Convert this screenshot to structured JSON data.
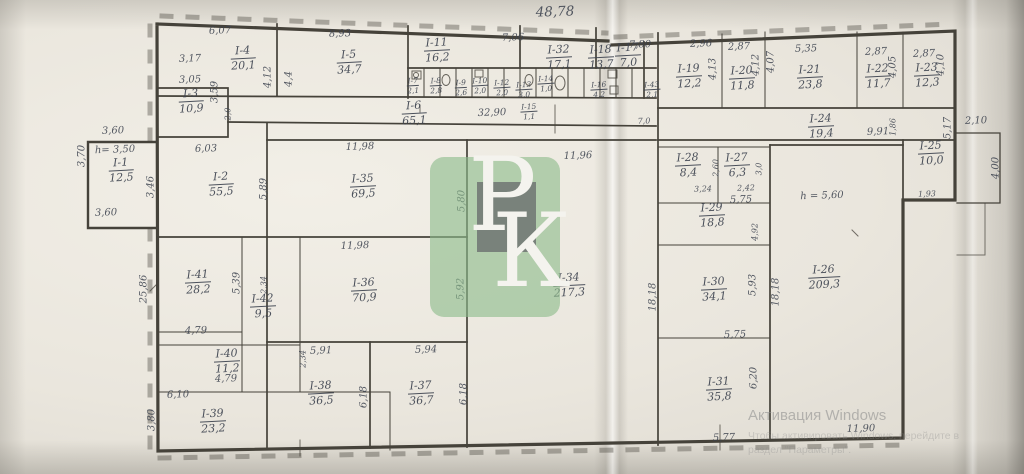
{
  "colors": {
    "ink": "#3e4450",
    "wall": "#45423a",
    "paper": "#ece8df",
    "logo_green": "#8dbc8a"
  },
  "windows_watermark": {
    "line1": "Активация Windows",
    "line2": "Чтобы активировать Windows, перейдите в",
    "line3": "раздел \"Параметры\"."
  },
  "watermark_logo": {
    "letter_p": "Р",
    "letter_k": "К"
  },
  "plan": {
    "overall_length": "48,78",
    "rooms": [
      {
        "id": "I-1",
        "area": "12,5",
        "x": 121,
        "y": 170
      },
      {
        "id": "I-2",
        "area": "55,5",
        "x": 221,
        "y": 184
      },
      {
        "id": "I-3",
        "area": "10,9",
        "x": 191,
        "y": 101
      },
      {
        "id": "I-4",
        "area": "20,1",
        "x": 243,
        "y": 58
      },
      {
        "id": "I-5",
        "area": "34,7",
        "x": 349,
        "y": 62
      },
      {
        "id": "I-6",
        "area": "65,1",
        "x": 414,
        "y": 113
      },
      {
        "id": "I-7",
        "area": "2,1",
        "x": 413,
        "y": 86,
        "small": true
      },
      {
        "id": "I-8",
        "area": "2,8",
        "x": 436,
        "y": 86,
        "small": true
      },
      {
        "id": "I-9",
        "area": "2,6",
        "x": 461,
        "y": 88,
        "small": true
      },
      {
        "id": "I-10",
        "area": "2,0",
        "x": 480,
        "y": 86,
        "small": true
      },
      {
        "id": "I-11",
        "area": "16,2",
        "x": 437,
        "y": 50
      },
      {
        "id": "I-12",
        "area": "2,0",
        "x": 502,
        "y": 88,
        "small": true
      },
      {
        "id": "I-13",
        "area": "3,0",
        "x": 524,
        "y": 90,
        "small": true
      },
      {
        "id": "I-14",
        "area": "1,0",
        "x": 546,
        "y": 84,
        "small": true
      },
      {
        "id": "I-15",
        "area": "1,1",
        "x": 529,
        "y": 112,
        "small": true
      },
      {
        "id": "I-16",
        "area": "4,2",
        "x": 599,
        "y": 90,
        "small": true
      },
      {
        "id": "I-17",
        "area": "7,0",
        "x": 628,
        "y": 55
      },
      {
        "id": "I-18",
        "area": "13,7",
        "x": 601,
        "y": 57
      },
      {
        "id": "I-19",
        "area": "12,2",
        "x": 689,
        "y": 76
      },
      {
        "id": "I-20",
        "area": "11,8",
        "x": 742,
        "y": 78
      },
      {
        "id": "I-21",
        "area": "23,8",
        "x": 810,
        "y": 77
      },
      {
        "id": "I-22",
        "area": "11,7",
        "x": 878,
        "y": 76
      },
      {
        "id": "I-23",
        "area": "12,3",
        "x": 927,
        "y": 75
      },
      {
        "id": "I-24",
        "area": "19,4",
        "x": 821,
        "y": 126
      },
      {
        "id": "I-25",
        "area": "10,0",
        "x": 931,
        "y": 153
      },
      {
        "id": "I-26",
        "area": "209,3",
        "x": 824,
        "y": 277
      },
      {
        "id": "I-27",
        "area": "6,3",
        "x": 737,
        "y": 165
      },
      {
        "id": "I-28",
        "area": "8,4",
        "x": 688,
        "y": 165
      },
      {
        "id": "I-29",
        "area": "18,8",
        "x": 712,
        "y": 215
      },
      {
        "id": "I-30",
        "area": "34,1",
        "x": 714,
        "y": 289
      },
      {
        "id": "I-31",
        "area": "35,8",
        "x": 719,
        "y": 389
      },
      {
        "id": "I-32",
        "area": "17,1",
        "x": 559,
        "y": 57
      },
      {
        "id": "I-34",
        "area": "217,3",
        "x": 569,
        "y": 285
      },
      {
        "id": "I-35",
        "area": "69,5",
        "x": 363,
        "y": 186
      },
      {
        "id": "I-36",
        "area": "70,9",
        "x": 364,
        "y": 290
      },
      {
        "id": "I-37",
        "area": "36,7",
        "x": 421,
        "y": 393
      },
      {
        "id": "I-38",
        "area": "36,5",
        "x": 321,
        "y": 393
      },
      {
        "id": "I-39",
        "area": "23,2",
        "x": 213,
        "y": 421
      },
      {
        "id": "I-40",
        "area": "11,2",
        "x": 227,
        "y": 361
      },
      {
        "id": "I-41",
        "area": "28,2",
        "x": 198,
        "y": 282
      },
      {
        "id": "I-42",
        "area": "9,5",
        "x": 263,
        "y": 306
      },
      {
        "id": "I-43",
        "area": "2,1",
        "x": 652,
        "y": 90,
        "small": true
      }
    ],
    "dims": [
      {
        "t": "48,78",
        "x": 555,
        "y": 12,
        "cls": "big"
      },
      {
        "t": "6,07",
        "x": 220,
        "y": 31
      },
      {
        "t": "8,93",
        "x": 340,
        "y": 34
      },
      {
        "t": "7,06",
        "x": 513,
        "y": 38
      },
      {
        "t": "7,80",
        "x": 640,
        "y": 45
      },
      {
        "t": "2,96",
        "x": 701,
        "y": 44
      },
      {
        "t": "2,87",
        "x": 739,
        "y": 47
      },
      {
        "t": "5,35",
        "x": 806,
        "y": 49
      },
      {
        "t": "2,87",
        "x": 876,
        "y": 52
      },
      {
        "t": "2,87",
        "x": 924,
        "y": 54
      },
      {
        "t": "3,17",
        "x": 190,
        "y": 59
      },
      {
        "t": "3,05",
        "x": 190,
        "y": 80
      },
      {
        "t": "3,59",
        "x": 215,
        "y": 92,
        "rot": true
      },
      {
        "t": "4,12",
        "x": 268,
        "y": 77,
        "rot": true
      },
      {
        "t": "4,4",
        "x": 289,
        "y": 79,
        "rot": true
      },
      {
        "t": "2,0",
        "x": 228,
        "y": 114,
        "rot": true,
        "cls": "small"
      },
      {
        "t": "32,90",
        "x": 492,
        "y": 113
      },
      {
        "t": "7,0",
        "x": 644,
        "y": 121,
        "cls": "small"
      },
      {
        "t": "4,13",
        "x": 713,
        "y": 69,
        "rot": true
      },
      {
        "t": "4,12",
        "x": 756,
        "y": 65,
        "rot": true
      },
      {
        "t": "4,07",
        "x": 771,
        "y": 62,
        "rot": true
      },
      {
        "t": "4,05",
        "x": 893,
        "y": 67,
        "rot": true
      },
      {
        "t": "4,10",
        "x": 941,
        "y": 65,
        "rot": true
      },
      {
        "t": "9,91",
        "x": 878,
        "y": 132
      },
      {
        "t": "1,86",
        "x": 893,
        "y": 127,
        "rot": true,
        "cls": "small"
      },
      {
        "t": "5,17",
        "x": 948,
        "y": 128,
        "rot": true
      },
      {
        "t": "2,10",
        "x": 976,
        "y": 121
      },
      {
        "t": "4,00",
        "x": 996,
        "y": 168,
        "rot": true
      },
      {
        "t": "1,93",
        "x": 927,
        "y": 194,
        "cls": "small"
      },
      {
        "t": "3,60",
        "x": 113,
        "y": 131
      },
      {
        "t": "3,70",
        "x": 82,
        "y": 156,
        "rot": true
      },
      {
        "t": "h= 3,50",
        "x": 115,
        "y": 150
      },
      {
        "t": "3,60",
        "x": 106,
        "y": 213
      },
      {
        "t": "3,46",
        "x": 151,
        "y": 187,
        "rot": true
      },
      {
        "t": "6,03",
        "x": 206,
        "y": 149
      },
      {
        "t": "5,89",
        "x": 264,
        "y": 189,
        "rot": true
      },
      {
        "t": "11,98",
        "x": 360,
        "y": 147
      },
      {
        "t": "5,80",
        "x": 462,
        "y": 201,
        "rot": true
      },
      {
        "t": "11,96",
        "x": 578,
        "y": 156
      },
      {
        "t": "11,98",
        "x": 355,
        "y": 246
      },
      {
        "t": "5,92",
        "x": 461,
        "y": 289,
        "rot": true
      },
      {
        "t": "25,86",
        "x": 144,
        "y": 289,
        "rot": true
      },
      {
        "t": "5,39",
        "x": 237,
        "y": 283,
        "rot": true
      },
      {
        "t": "2,34",
        "x": 264,
        "y": 285,
        "rot": true,
        "cls": "small"
      },
      {
        "t": "4,79",
        "x": 196,
        "y": 331
      },
      {
        "t": "2,34",
        "x": 303,
        "y": 359,
        "rot": true,
        "cls": "small"
      },
      {
        "t": "4,79",
        "x": 226,
        "y": 379
      },
      {
        "t": "6,10",
        "x": 178,
        "y": 395
      },
      {
        "t": "3,80",
        "x": 152,
        "y": 420,
        "rot": true
      },
      {
        "t": "5,91",
        "x": 321,
        "y": 351
      },
      {
        "t": "5,94",
        "x": 426,
        "y": 350
      },
      {
        "t": "6,18",
        "x": 364,
        "y": 397,
        "rot": true
      },
      {
        "t": "6,18",
        "x": 464,
        "y": 394,
        "rot": true
      },
      {
        "t": "3,24",
        "x": 703,
        "y": 189,
        "cls": "small"
      },
      {
        "t": "2,42",
        "x": 746,
        "y": 188,
        "cls": "small"
      },
      {
        "t": "2,60",
        "x": 716,
        "y": 168,
        "rot": true,
        "cls": "small"
      },
      {
        "t": "3,0",
        "x": 759,
        "y": 169,
        "rot": true,
        "cls": "small"
      },
      {
        "t": "5,75",
        "x": 741,
        "y": 200
      },
      {
        "t": "4,92",
        "x": 755,
        "y": 232,
        "rot": true,
        "cls": "small"
      },
      {
        "t": "5,93",
        "x": 753,
        "y": 285,
        "rot": true
      },
      {
        "t": "18,18",
        "x": 653,
        "y": 297,
        "rot": true
      },
      {
        "t": "18,18",
        "x": 776,
        "y": 292,
        "rot": true
      },
      {
        "t": "5,75",
        "x": 735,
        "y": 335
      },
      {
        "t": "6,20",
        "x": 754,
        "y": 378,
        "rot": true
      },
      {
        "t": "h = 5,60",
        "x": 822,
        "y": 196
      },
      {
        "t": "5,77",
        "x": 724,
        "y": 438
      },
      {
        "t": "11,90",
        "x": 861,
        "y": 429
      }
    ]
  }
}
